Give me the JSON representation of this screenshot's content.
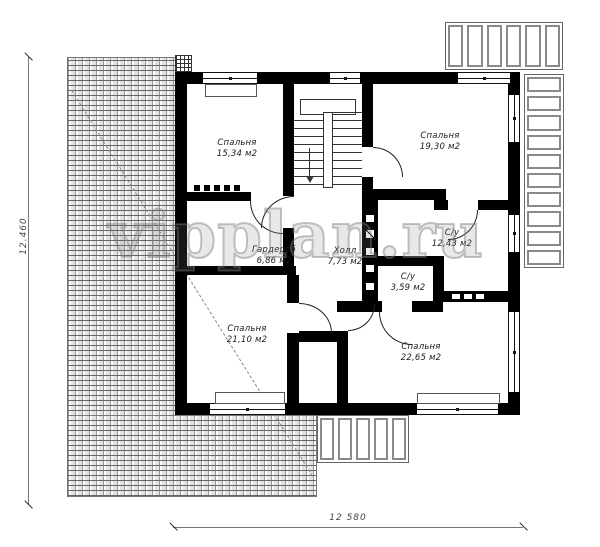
{
  "drawing": {
    "watermark": "vipplan.ru",
    "rooms": [
      {
        "name": "Спальня",
        "area": "15,34 м2"
      },
      {
        "name": "Спальня",
        "area": "19,30 м2"
      },
      {
        "name": "Гардероб",
        "area": "6,86 м2"
      },
      {
        "name": "Холл",
        "area": "7,73 м2"
      },
      {
        "name": "С/у",
        "area": "12,43 м2"
      },
      {
        "name": "С/у",
        "area": "3,59 м2"
      },
      {
        "name": "Спальня",
        "area": "21,10 м2"
      },
      {
        "name": "Спальня",
        "area": "22,65 м2"
      }
    ],
    "dimensions": {
      "vertical": "12.460",
      "horizontal": "12 580"
    },
    "colors": {
      "wall": "#000000",
      "line": "#444444",
      "hatch": "#8a8a8a",
      "paper": "#ffffff"
    }
  }
}
